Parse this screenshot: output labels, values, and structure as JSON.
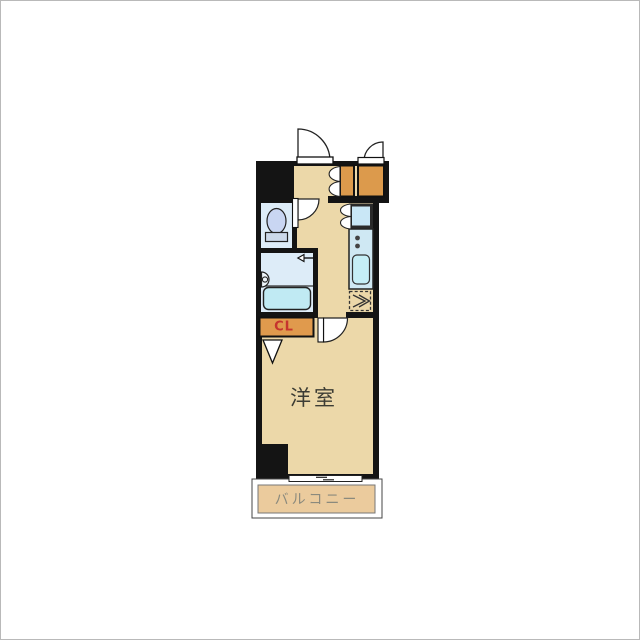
{
  "floorplan": {
    "labels": {
      "room": "洋室",
      "balcony": "バルコニー",
      "closet": "CL"
    },
    "colors": {
      "wall": "#141414",
      "floor": "#ecd8a9",
      "balcony_floor": "#ebcb9d",
      "storage": "#dc9a4c",
      "closet_box": "#e09a4d",
      "closet_text": "#c6342e",
      "wet_room": "#ddecf8",
      "toilet_bowl": "#c9d6f2",
      "toilet_base": "#ccd9ea",
      "bathtub": "#c0eaf3",
      "kitchen_counter": "#cfe8f3",
      "sink": "#c5eef6",
      "washer_space": "#c9e7f6",
      "door": "#ffffff",
      "room_text": "#3c3c34",
      "balcony_text": "#8b8a7d",
      "outline": "#222222"
    }
  }
}
